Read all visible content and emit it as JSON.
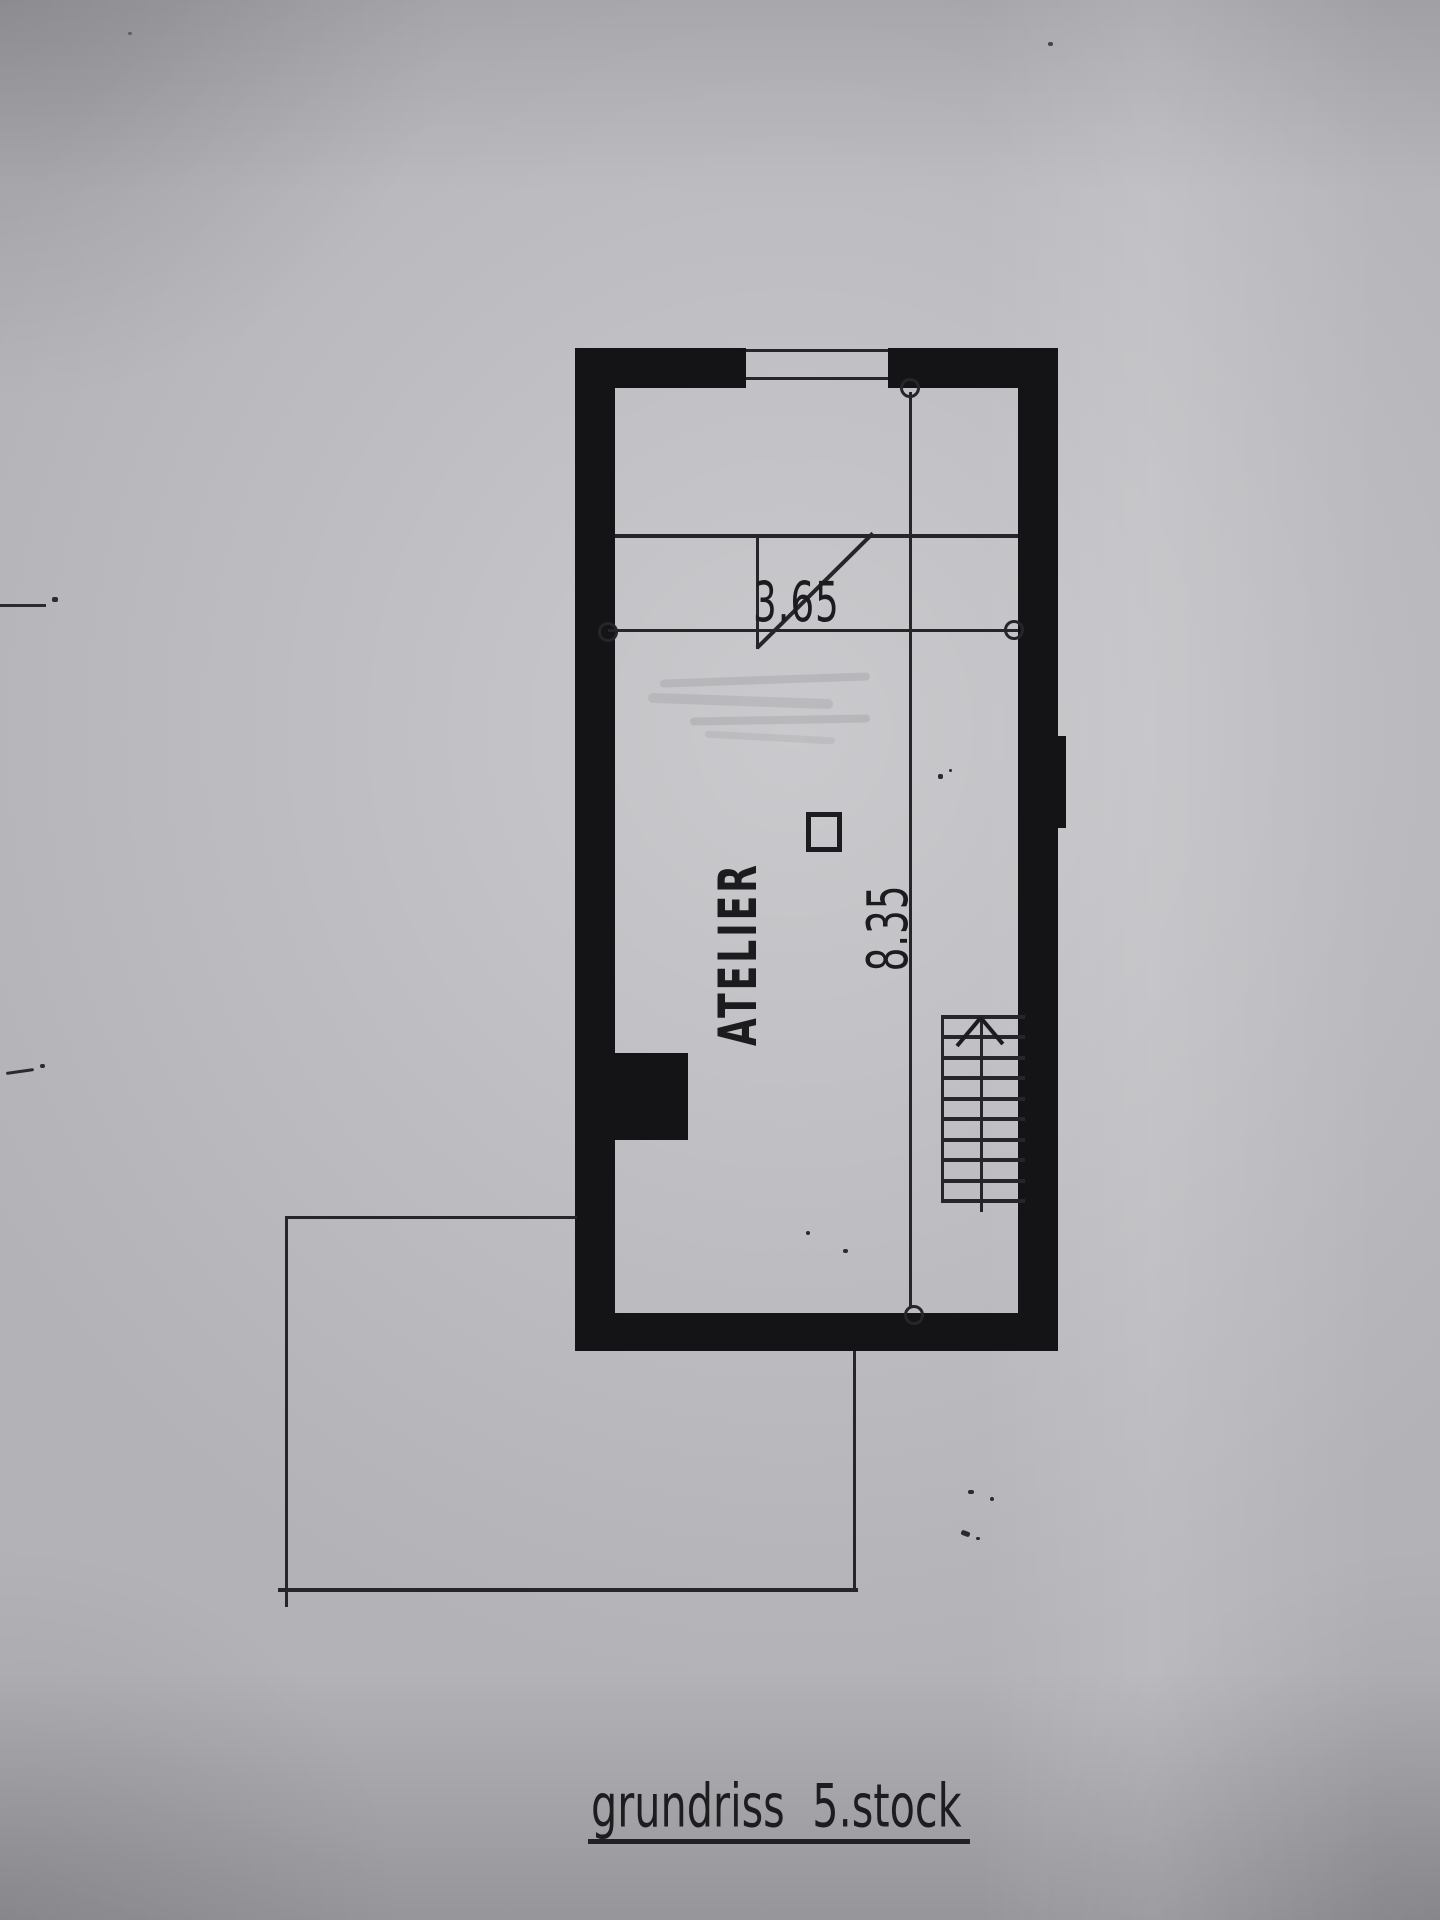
{
  "document": {
    "title": "grundriss 5.stock"
  },
  "plan": {
    "room_label": "ATELIER",
    "dimensions": {
      "width_label": "3.65",
      "height_label": "8.35"
    },
    "stairs": {
      "tread_count": 10,
      "direction_icon": "up-arrow"
    },
    "colors": {
      "ink": "#1c1b1d",
      "wall_fill": "#141316",
      "paper_base": "#b3b2b7",
      "thin_line": "#26252a"
    }
  }
}
